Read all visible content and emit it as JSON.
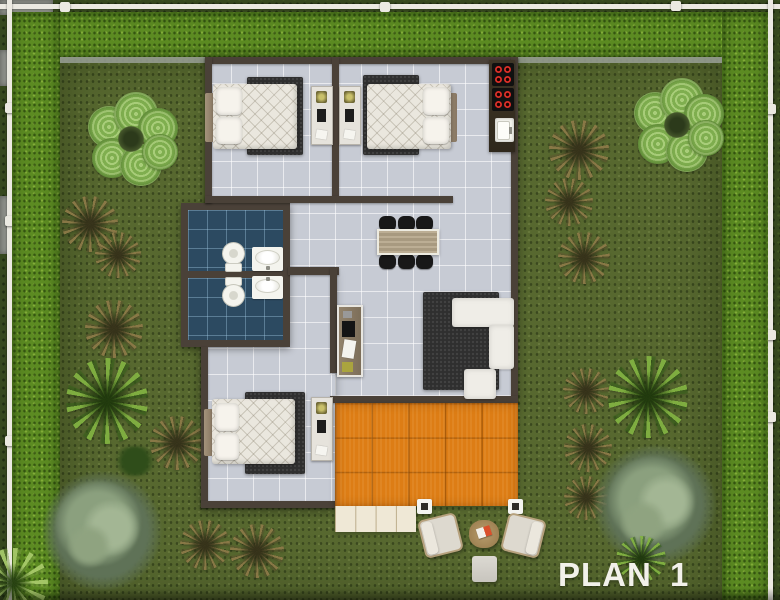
{
  "title": {
    "label": "PLAN 1"
  },
  "palette": {
    "outer-grass": "#36481e",
    "hedge": "#5c8b22",
    "lawn": "#57682f",
    "fence": "#ebe9e1",
    "wall": "#4a4138",
    "floor-tile": "#c7cbd4",
    "bath-tile": "#2c4a61",
    "rug": "#2f2f2f",
    "mattress": "#eae7de",
    "sofa": "#efede7",
    "deck": "#dd7d15",
    "stone-path": "#efe8d6",
    "counter": "#3f3627",
    "stove": "#101010",
    "burner": "#d92f28",
    "table-wood": "#b3a58b",
    "chair": "#181818",
    "fixture-white": "#f4f4ee",
    "title-color": "#f2f1ea"
  }
}
